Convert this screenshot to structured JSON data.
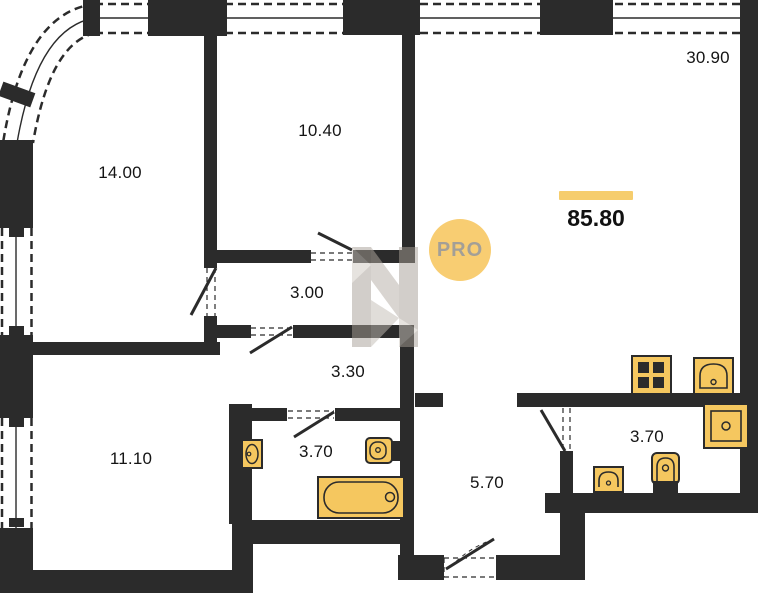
{
  "plan": {
    "watermark_badge": "PRO",
    "total": {
      "area": "85.80"
    },
    "rooms": [
      {
        "name": "living-kitchen",
        "area": "30.90"
      },
      {
        "name": "bedroom-1",
        "area": "14.00"
      },
      {
        "name": "bedroom-2",
        "area": "10.40"
      },
      {
        "name": "corridor",
        "area": "3.00"
      },
      {
        "name": "hallway",
        "area": "3.30"
      },
      {
        "name": "bedroom-3",
        "area": "11.10"
      },
      {
        "name": "bathroom-1",
        "area": "3.70"
      },
      {
        "name": "entry-hall",
        "area": "5.70"
      },
      {
        "name": "bathroom-2",
        "area": "3.70"
      }
    ],
    "colors": {
      "wall": "#2b2b2b",
      "fixture_fill": "#f5c75f",
      "accent_bar": "#f6cd6d",
      "badge_fill": "#f8cd72",
      "badge_text": "#a39f97",
      "watermark": "#a79f96"
    }
  }
}
